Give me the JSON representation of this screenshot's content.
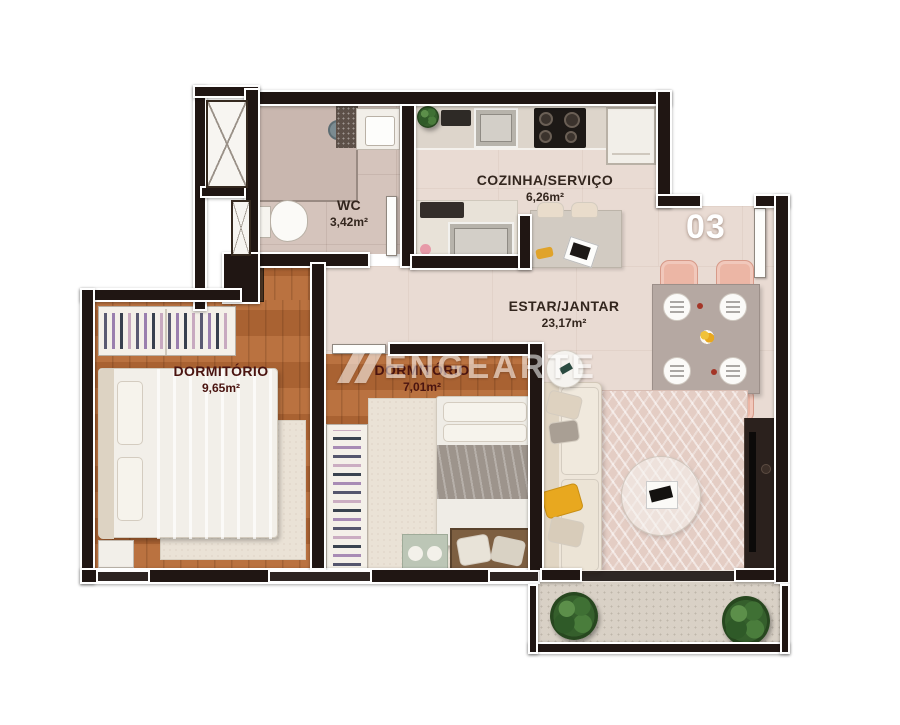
{
  "unit_number": "03",
  "watermark": {
    "text": "ENGEARTE"
  },
  "rooms": {
    "wc": {
      "name": "WC",
      "area": "3,42m²"
    },
    "kitchen": {
      "name": "COZINHA/SERVIÇO",
      "area": "6,26m²"
    },
    "living": {
      "name": "ESTAR/JANTAR",
      "area": "23,17m²"
    },
    "bedroom1": {
      "name": "DORMITÓRIO",
      "area": "9,65m²"
    },
    "bedroom2": {
      "name": "DORMITÓRIO",
      "area": "7,01m²"
    }
  },
  "colors": {
    "wall": "#201613",
    "wall_outline": "#ffffff",
    "wood_floor": "#b26836",
    "tile_floor": "#e9dbd3",
    "wc_tile": "#d5c4bc",
    "rug": "#e4cdc4",
    "dining_chair": "#ecb6a5",
    "sofa": "#eee6da",
    "accent_pillow": "#e8a81f",
    "label_dark": "#33261e",
    "label_bedroom": "#4a1410",
    "unit_number_text": "#ffffff",
    "plant": "#355f2c",
    "balcony_floor": "#d9d1c6"
  }
}
